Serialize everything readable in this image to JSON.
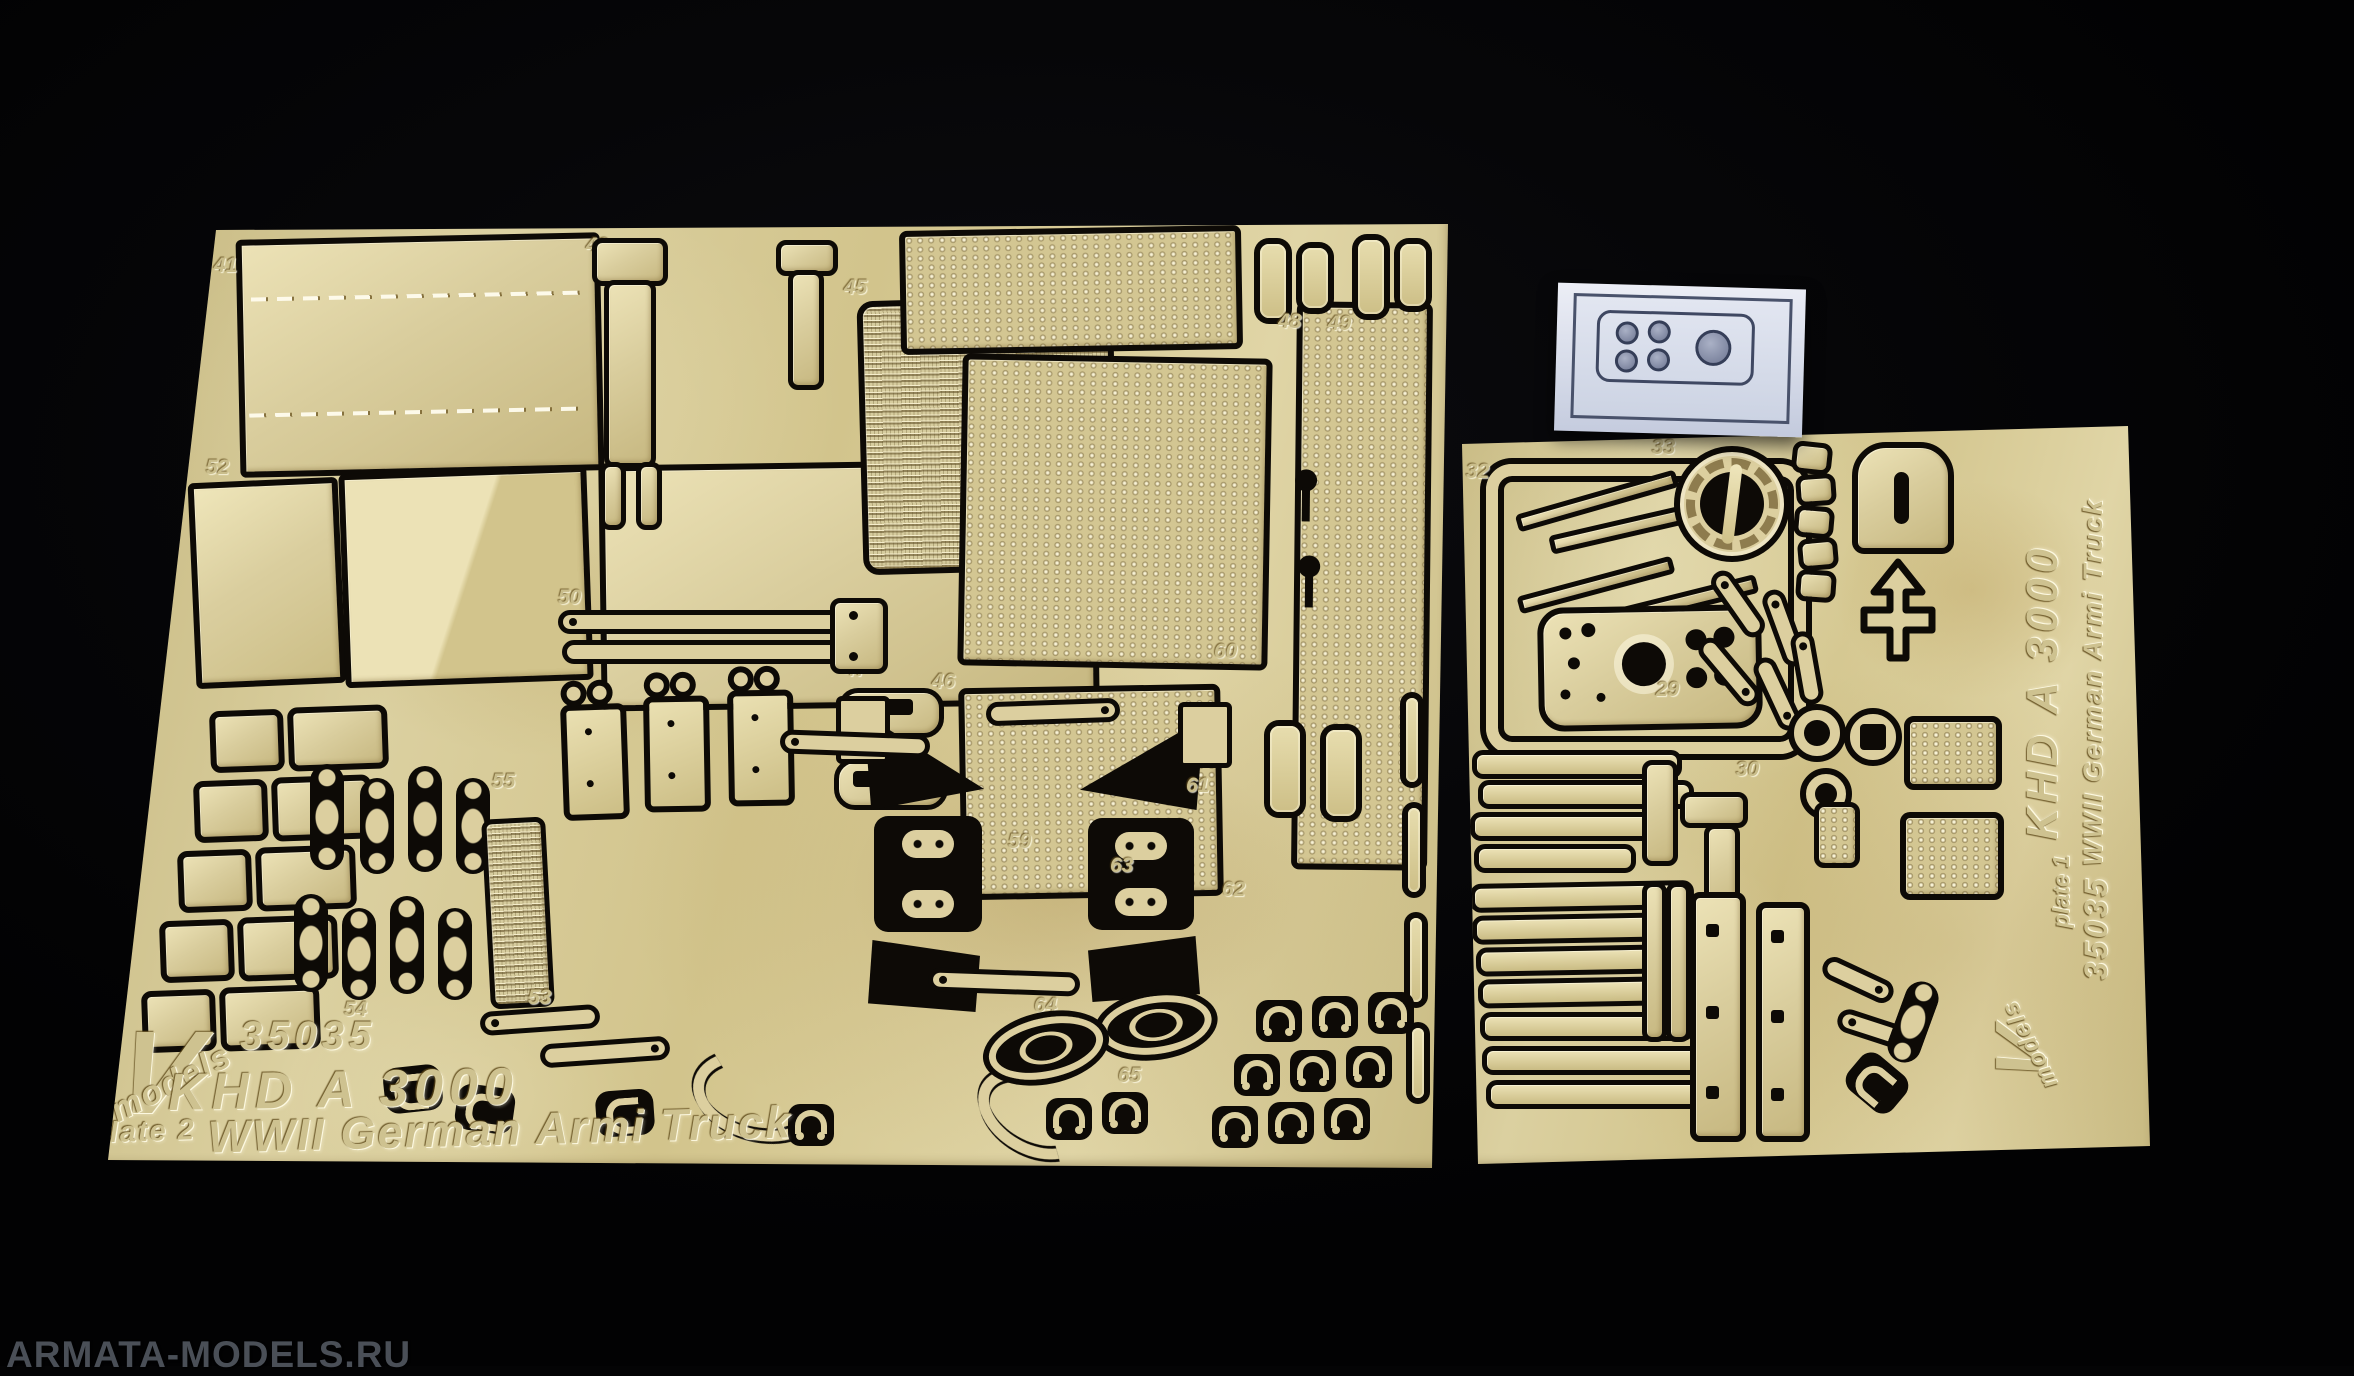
{
  "scene": {
    "watermark": "ARMATA-MODELS.RU",
    "colors": {
      "background": "#050506",
      "brass": "#d8cc9c",
      "brass_highlight": "#ece2b6",
      "brass_shadow": "#b9a873",
      "cut_gap": "#0d0a06",
      "film": "#dde2ee",
      "film_line": "#49526b",
      "watermark_gray": "#4a4f57"
    }
  },
  "left_sheet": {
    "brand_v": "V",
    "brand_name": "models",
    "code": "35035",
    "title": "KHD A 3000",
    "plate": "plate 2",
    "subtitle": "WWII German Armi Truck"
  },
  "right_sheet": {
    "brand_v": "V",
    "brand_name": "models",
    "code": "35035",
    "title": "KHD A 3000",
    "plate": "plate 1",
    "subtitle": "WWII German Armi Truck"
  },
  "part_numbers": {
    "left": {
      "n41": "41",
      "n43": "43",
      "n44": "44",
      "n45": "45",
      "n46": "46",
      "n47": "47",
      "n48": "48",
      "n49": "49",
      "n50": "50",
      "n52": "52",
      "n53": "53",
      "n54": "54",
      "n54b": "54",
      "n55": "55",
      "n59": "59",
      "n60": "60",
      "n61": "61",
      "n62": "62",
      "n63": "63",
      "n64": "64",
      "n65": "65"
    },
    "right": {
      "n29": "29",
      "n30": "30",
      "n32": "32",
      "n33": "33"
    }
  }
}
